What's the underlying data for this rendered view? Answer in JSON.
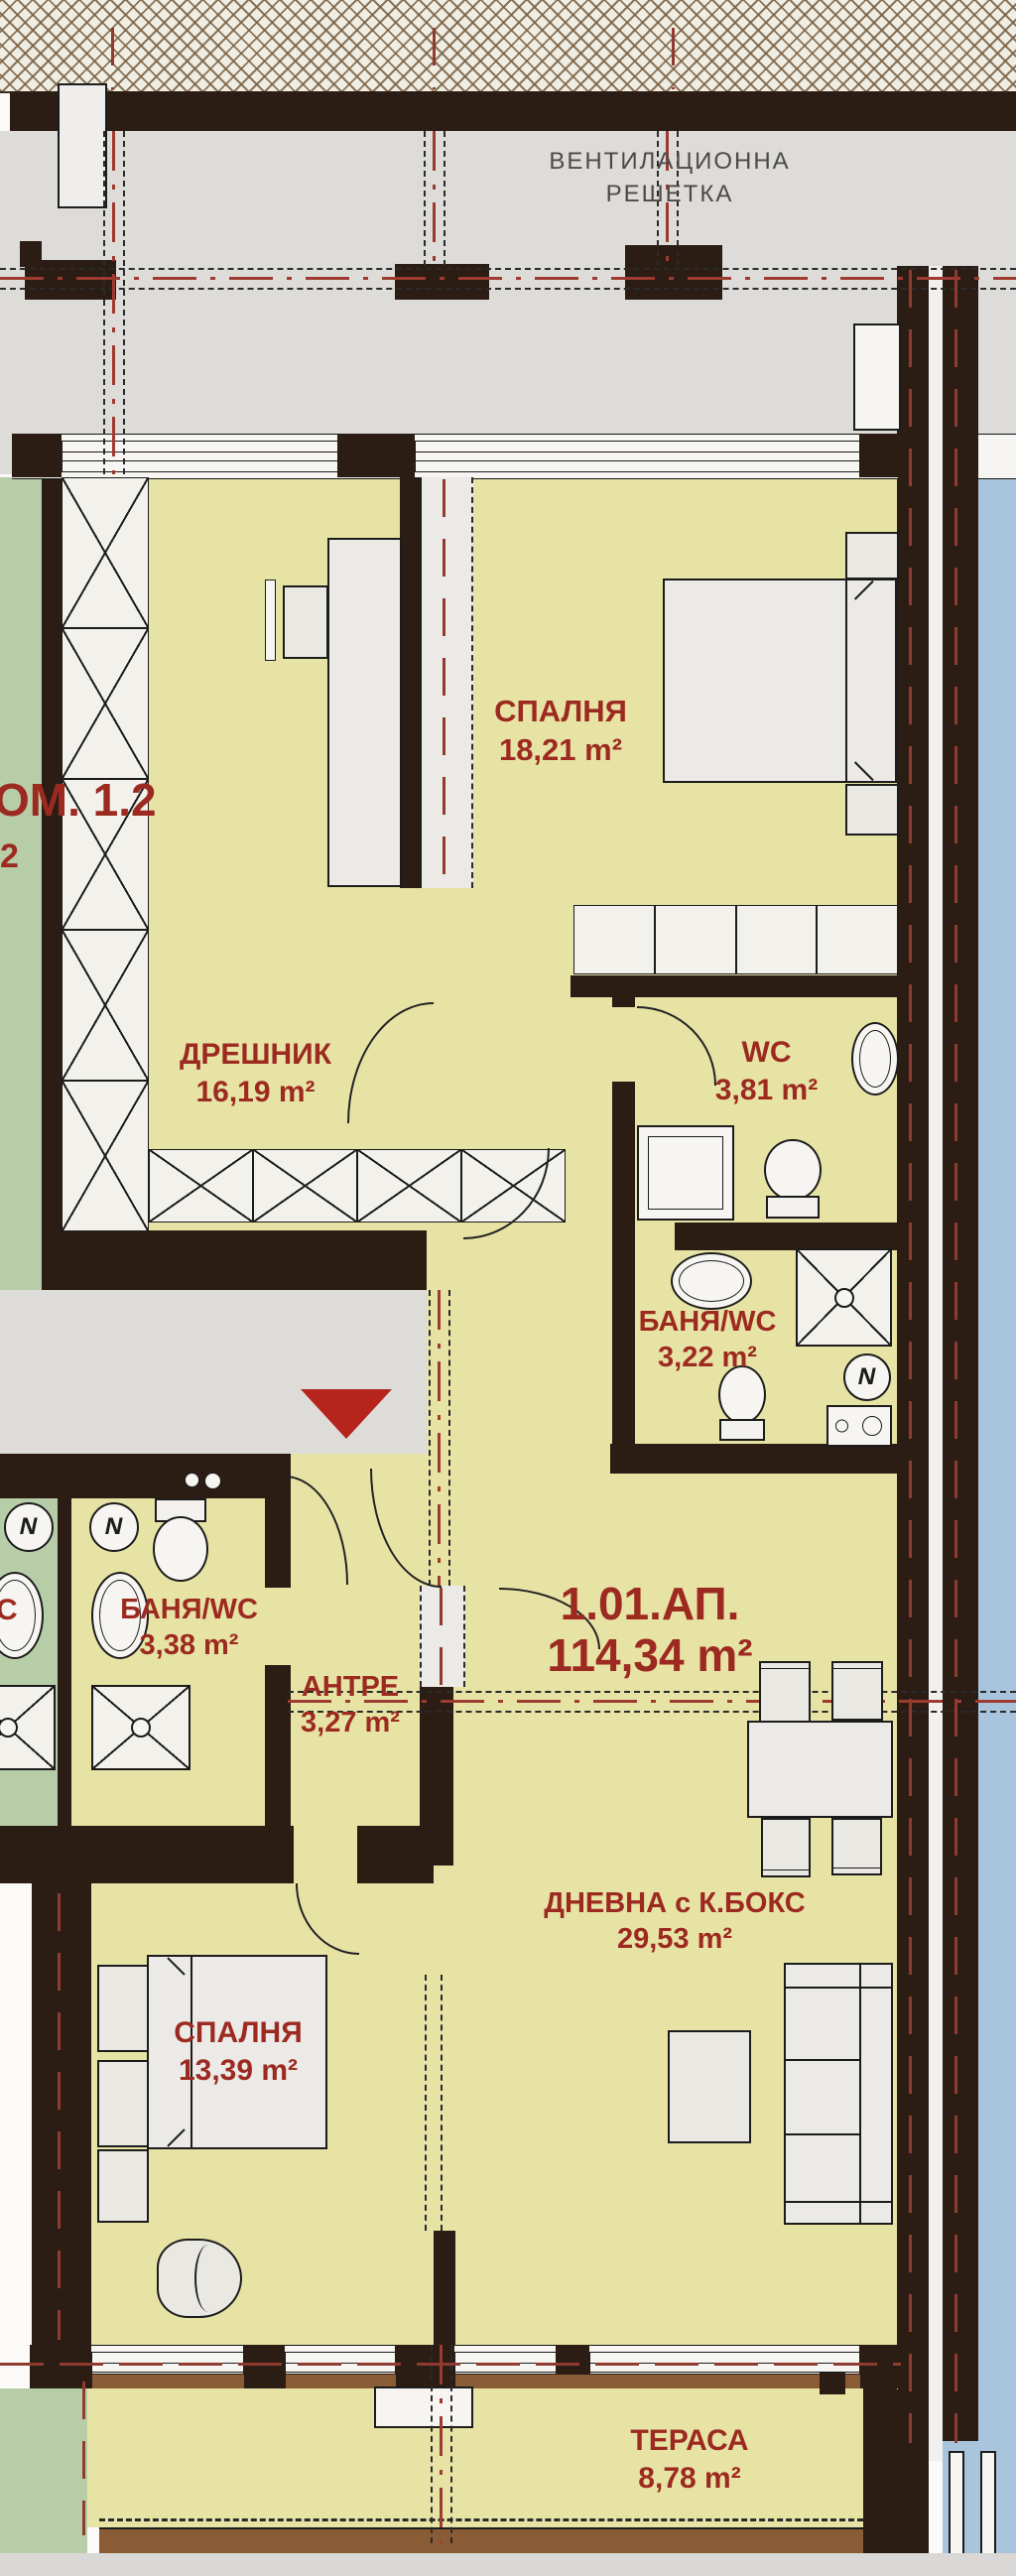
{
  "plan": {
    "title_note": {
      "line1": "ВЕНТИЛАЦИОННА",
      "line2": "РЕШЕТКА"
    },
    "apartment": {
      "id": "1.01.АП.",
      "area": "114,34 m²"
    },
    "rooms": [
      {
        "id": "bedroom-1",
        "name": "СПАЛНЯ",
        "area": "18,21 m²"
      },
      {
        "id": "dressing-room",
        "name": "ДРЕШНИК",
        "area": "16,19 m²"
      },
      {
        "id": "wc",
        "name": "WC",
        "area": "3,81 m²"
      },
      {
        "id": "bath-wc-small",
        "name": "БАНЯ/WC",
        "area": "3,22 m²"
      },
      {
        "id": "bath-wc-main",
        "name": "БАНЯ/WC",
        "area": "3,38 m²"
      },
      {
        "id": "entry-hall",
        "name": "АНТРЕ",
        "area": "3,27 m²"
      },
      {
        "id": "living-kitchen",
        "name": "ДНЕВНА с К.БОКС",
        "area": "29,53 m²"
      },
      {
        "id": "bedroom-2",
        "name": "СПАЛНЯ",
        "area": "13,39 m²"
      },
      {
        "id": "terrace",
        "name": "ТЕРАСА",
        "area": "8,78 m²"
      }
    ],
    "adjacent": {
      "room_label": "ОМ. 1.2",
      "area_fragment": "2",
      "bath_fragment": "C"
    },
    "symbols": {
      "water_heater_glyph": "N"
    },
    "colors": {
      "wall": "#2b1d14",
      "room_fill": "#e7e3a5",
      "adjacent_fill": "#b7cda8",
      "adjacent_terrace_fill": "#a9c5dd",
      "corridor_fill": "#dedcd9",
      "axis_red": "#9e3a30",
      "label_red": "#9c2a21",
      "entrance_marker_red": "#b5251c",
      "railing_brown": "#8a5c36"
    }
  }
}
